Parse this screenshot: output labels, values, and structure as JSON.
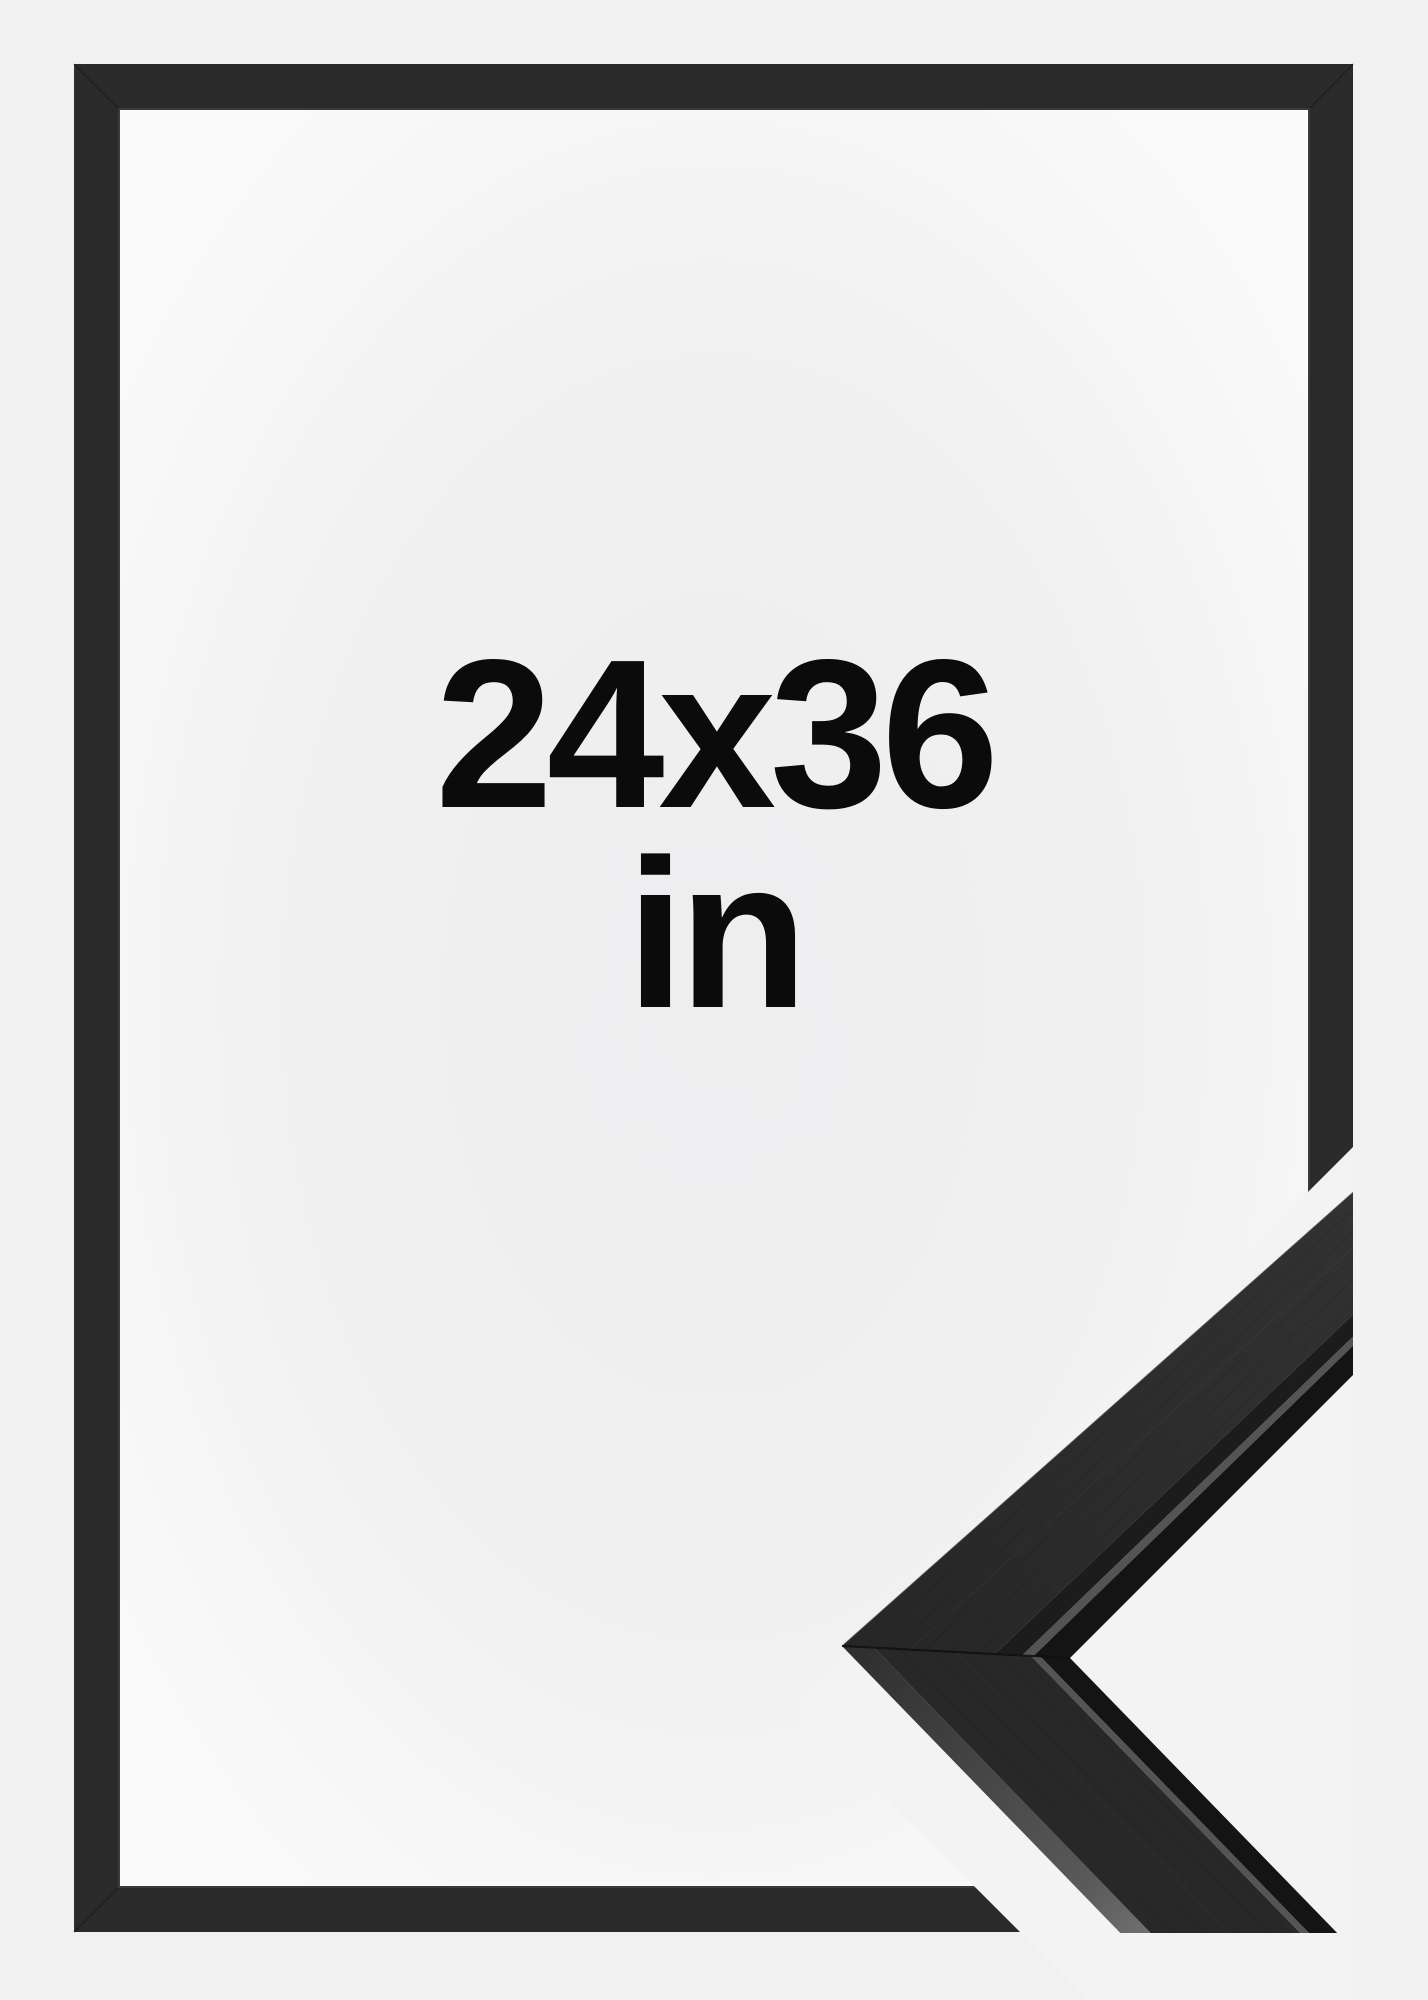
{
  "product_image": {
    "kind": "picture-frame-size-mockup",
    "size_label": {
      "dimensions": "24x36",
      "unit": "in"
    }
  },
  "colors": {
    "background": "#f1f1f2",
    "cutout_band": "#f3f3f4",
    "frame": "#2a2a2a",
    "frame_inner_lip": "#3a3a3a",
    "frame_miter_seam": "#1a1a1a",
    "text": "#0b0b0b",
    "interior_center": "#eeeeef",
    "interior_edge": "#fafafa",
    "moulding_front_upper": "#2e2e2e",
    "moulding_front_lower": "#282828",
    "moulding_arris": "#1c1c1c",
    "moulding_highlight": "#545454",
    "moulding_inner_dark": "#141414",
    "moulding_outer_side_near": "#303030",
    "moulding_outer_side_far": "#8a8a8a"
  }
}
